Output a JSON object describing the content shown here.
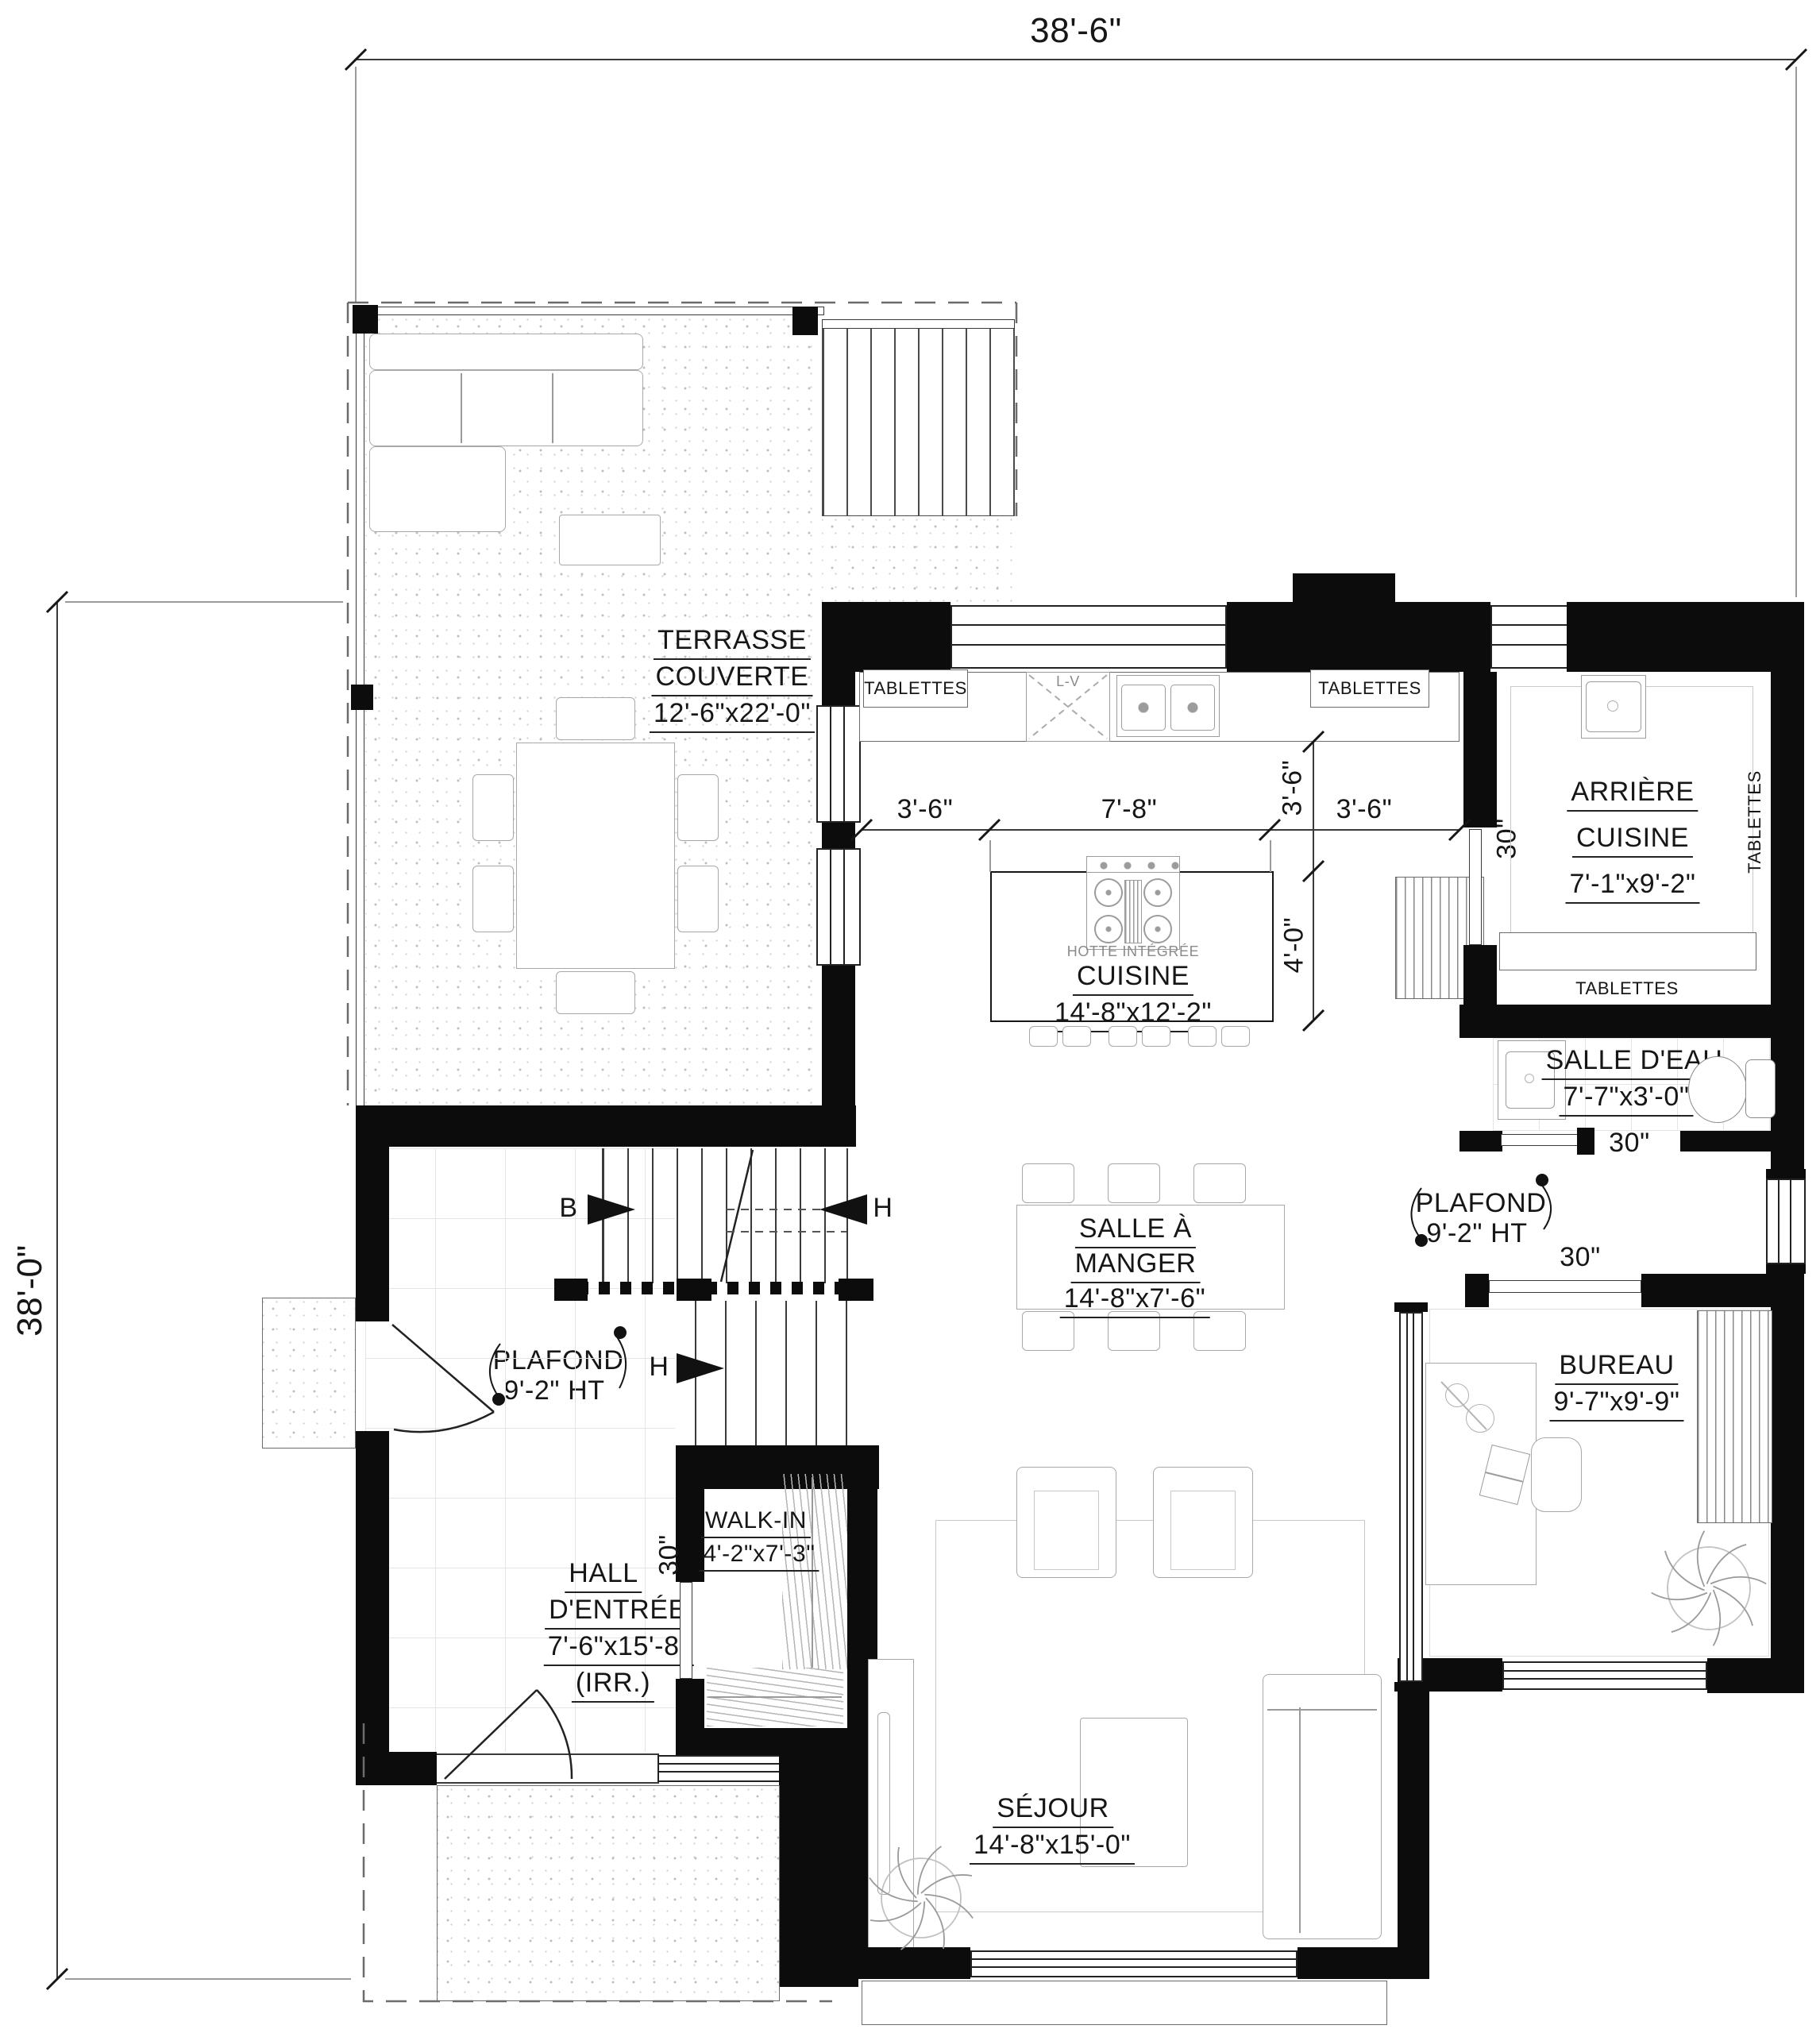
{
  "overall": {
    "width_label": "38'-6\"",
    "height_label": "38'-0\""
  },
  "rooms": {
    "terrasse": {
      "l1": "TERRASSE",
      "l2": "COUVERTE",
      "dims": "12'-6\"x22'-0\""
    },
    "cuisine": {
      "l1": "CUISINE",
      "dims": "14'-8\"x12'-2\""
    },
    "arriere": {
      "l1": "ARRIÈRE",
      "l2": "CUISINE",
      "dims": "7'-1\"x9'-2\""
    },
    "salle_eau": {
      "l1": "SALLE D'EAU",
      "dims": "7'-7\"x3'-0\""
    },
    "salle_manger": {
      "l1": "SALLE À",
      "l2": "MANGER",
      "dims": "14'-8\"x7'-6\""
    },
    "bureau": {
      "l1": "BUREAU",
      "dims": "9'-7\"x9'-9\""
    },
    "hall": {
      "l1": "HALL",
      "l2": "D'ENTRÉE",
      "dims": "7'-6\"x15'-8\"",
      "note": "(IRR.)"
    },
    "walkin": {
      "l1": "WALK-IN",
      "dims": "4'-2\"x7'-3\""
    },
    "sejour": {
      "l1": "SÉJOUR",
      "dims": "14'-8\"x15'-0\""
    }
  },
  "annotations": {
    "plafond": {
      "l1": "PLAFOND",
      "l2": "9'-2\" HT"
    },
    "hotte": "HOTTE INTÉGRÉE",
    "dishwasher": "L-V",
    "shelves": "TABLETTES",
    "door_width": "30\"",
    "section_basement": "B",
    "section_up": "H"
  },
  "dimensions": {
    "island_left": "3'-6\"",
    "island_center": "7'-8\"",
    "island_right": "3'-6\"",
    "counter_to_island": "3'-6\"",
    "island_depth": "4'-0\""
  }
}
